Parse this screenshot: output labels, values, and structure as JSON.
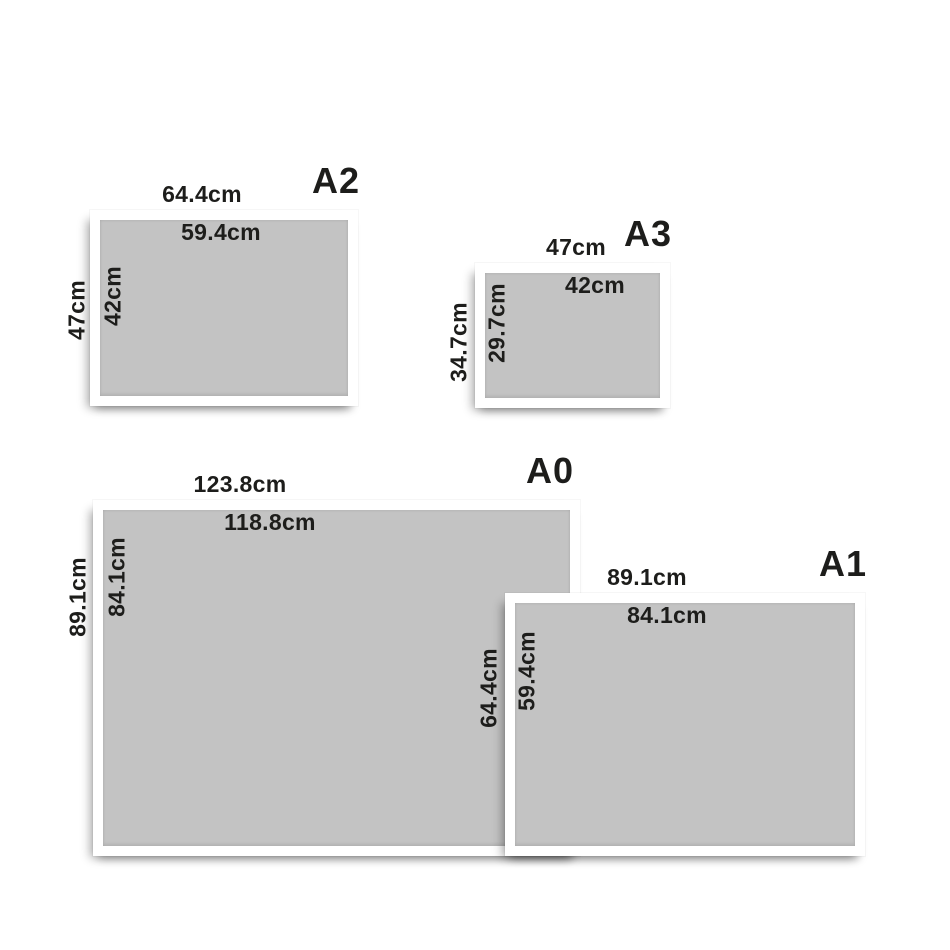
{
  "frames": [
    {
      "id": "a2",
      "name": "A2",
      "outer_width": "64.4cm",
      "inner_width": "59.4cm",
      "outer_height": "47cm",
      "inner_height": "42cm"
    },
    {
      "id": "a3",
      "name": "A3",
      "outer_width": "47cm",
      "inner_width": "42cm",
      "outer_height": "34.7cm",
      "inner_height": "29.7cm"
    },
    {
      "id": "a0",
      "name": "A0",
      "outer_width": "123.8cm",
      "inner_width": "118.8cm",
      "outer_height": "89.1cm",
      "inner_height": "84.1cm"
    },
    {
      "id": "a1",
      "name": "A1",
      "outer_width": "89.1cm",
      "inner_width": "84.1cm",
      "outer_height": "64.4cm",
      "inner_height": "59.4cm"
    }
  ],
  "colors": {
    "background": "#ffffff",
    "frame": "#ffffff",
    "paper": "#c3c3c3",
    "text": "#1d1d1b"
  }
}
